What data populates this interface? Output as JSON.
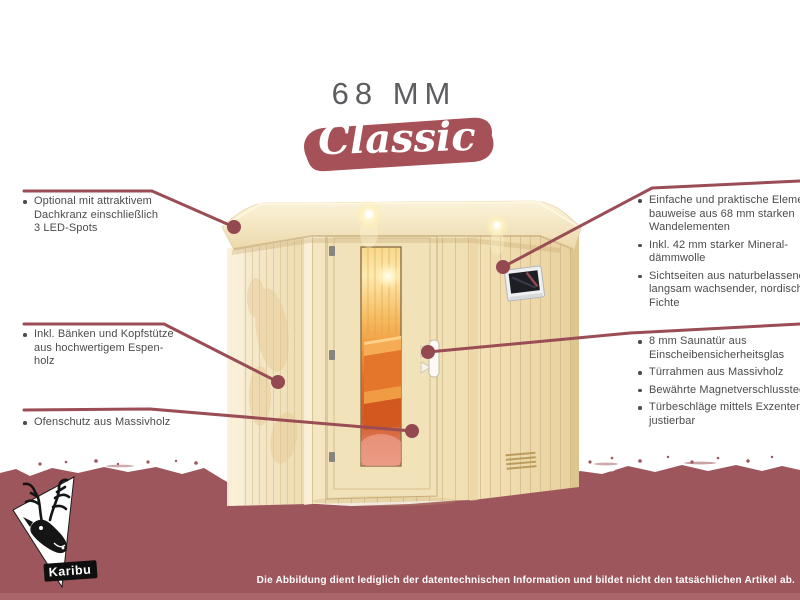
{
  "header": {
    "size_label": "68 MM",
    "series_label": "Classic"
  },
  "callouts": {
    "left": [
      {
        "lines": [
          "Optional mit attraktivem",
          "Dachkranz einschließlich",
          "3 LED-Spots"
        ]
      },
      {
        "lines": [
          "Inkl. Bänken und Kopfstütze",
          "aus hochwertigem Espen-",
          "holz"
        ]
      },
      {
        "lines": [
          "Ofenschutz aus Massivholz"
        ]
      }
    ],
    "right_top": [
      {
        "lines": [
          "Einfache und praktische Element-",
          "bauweise aus 68 mm starken",
          "Wandelementen"
        ]
      },
      {
        "lines": [
          "Inkl. 42 mm starker Mineral-",
          "dämmwolle"
        ]
      },
      {
        "lines": [
          "Sichtseiten aus naturbelassener,",
          "langsam wachsender, nordischer",
          "Fichte"
        ]
      }
    ],
    "right_bottom": [
      {
        "lines": [
          "8 mm Saunatür aus",
          "Einscheibensicherheitsglas"
        ]
      },
      {
        "lines": [
          "Türrahmen aus Massivholz"
        ]
      },
      {
        "lines": [
          "Bewährte Magnetverschlusstechnik"
        ]
      },
      {
        "lines": [
          "Türbeschläge mittels Exzenter",
          "justierbar"
        ]
      }
    ]
  },
  "footer": {
    "disclaimer": "Die Abbildung dient lediglich der datentechnischen Information und bildet nicht den tatsächlichen Artikel ab."
  },
  "brand": {
    "name": "Karibu",
    "logo": "deer-logo"
  },
  "colors": {
    "accent_red": "#9a4d55",
    "banner_red": "#a65157",
    "band_red": "#9d565c",
    "text_gray": "#4b4b4d",
    "title_gray": "#5c5d60",
    "wood_light": "#f4e6c0",
    "interior_orange": "#e87f2d"
  }
}
